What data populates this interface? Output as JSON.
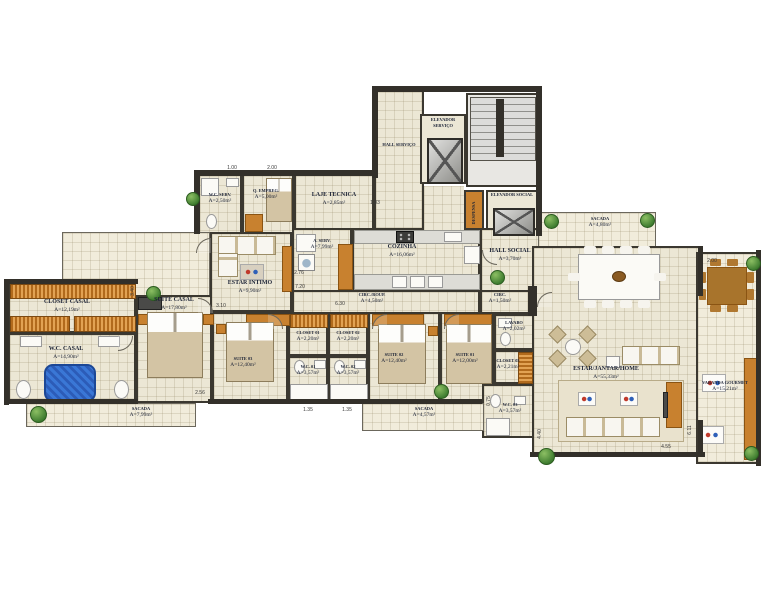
{
  "plan_type": "apartment floor plan",
  "rooms": [
    {
      "name": "HALL SERVIÇO",
      "area": ""
    },
    {
      "name": "ELEVADOR SERVIÇO",
      "area": ""
    },
    {
      "name": "ELEVADOR SOCIAL",
      "area": ""
    },
    {
      "name": "DESPENSA",
      "area": ""
    },
    {
      "name": "W.C. SERV.",
      "area": "A=2,50m²"
    },
    {
      "name": "Q. EMPREG.",
      "area": "A=5,00m²"
    },
    {
      "name": "LAJE TECNICA",
      "area": "A=2,85m²"
    },
    {
      "name": "A. SERV.",
      "area": "A=7,99m²"
    },
    {
      "name": "COZINHA",
      "area": "A=16,06m²"
    },
    {
      "name": "HALL SOCIAL",
      "area": "A=3,70m²"
    },
    {
      "name": "ESTAR INTIMO",
      "area": "A=9,90m²"
    },
    {
      "name": "CIRC./ROUP.",
      "area": "A=4,50m²"
    },
    {
      "name": "CIRC.",
      "area": "A=1,50m²"
    },
    {
      "name": "LAVABO",
      "area": "A=2,02m²"
    },
    {
      "name": "CLOSET CASAL",
      "area": "A=12,19m²"
    },
    {
      "name": "W.C. CASAL",
      "area": "A=14,90m²"
    },
    {
      "name": "SUITE CASAL",
      "area": "A=17,80m²"
    },
    {
      "name": "SUITE 03",
      "area": "A=12,40m²"
    },
    {
      "name": "CLOSET 01",
      "area": "A=2,20m²"
    },
    {
      "name": "CLOSET 02",
      "area": "A=2,20m²"
    },
    {
      "name": "W.C. 01",
      "area": "A=3,57m²"
    },
    {
      "name": "W.C. 02",
      "area": "A=3,57m²"
    },
    {
      "name": "SUITE 02",
      "area": "A=12,40m²"
    },
    {
      "name": "SUITE 01",
      "area": "A=12,00m²"
    },
    {
      "name": "CLOSET 03",
      "area": "A=2,21m²"
    },
    {
      "name": "W.C. 03",
      "area": "A=3,57m²"
    },
    {
      "name": "SACADA",
      "area": "A=4,80m²"
    },
    {
      "name": "ESTAR/JANTAR/HOME",
      "area": "A=55,33m²"
    },
    {
      "name": "VARANDA GOURMET",
      "area": "A=15,21m²"
    },
    {
      "name": "SACADA",
      "area": "A=7,99m²"
    },
    {
      "name": "SACADA",
      "area": "A=4,57m²"
    }
  ],
  "dims": [
    "3.10",
    "2.56",
    "7.20",
    "6.30",
    "2.76",
    "1.83",
    "2.00",
    "4.55",
    "6.11",
    "4.40",
    "1.35",
    "1.35",
    "3.40",
    "0.75",
    "1.00",
    "2.00"
  ],
  "colors": {
    "wall": "#33302a",
    "floor": "#ece7d5",
    "balcony_floor": "#f1ecdb",
    "wood_furniture": "#c8812f",
    "bathtub_blue": "#2f6fd0",
    "plant_green": "#3c7a2e",
    "label_text": "#1c2336"
  }
}
